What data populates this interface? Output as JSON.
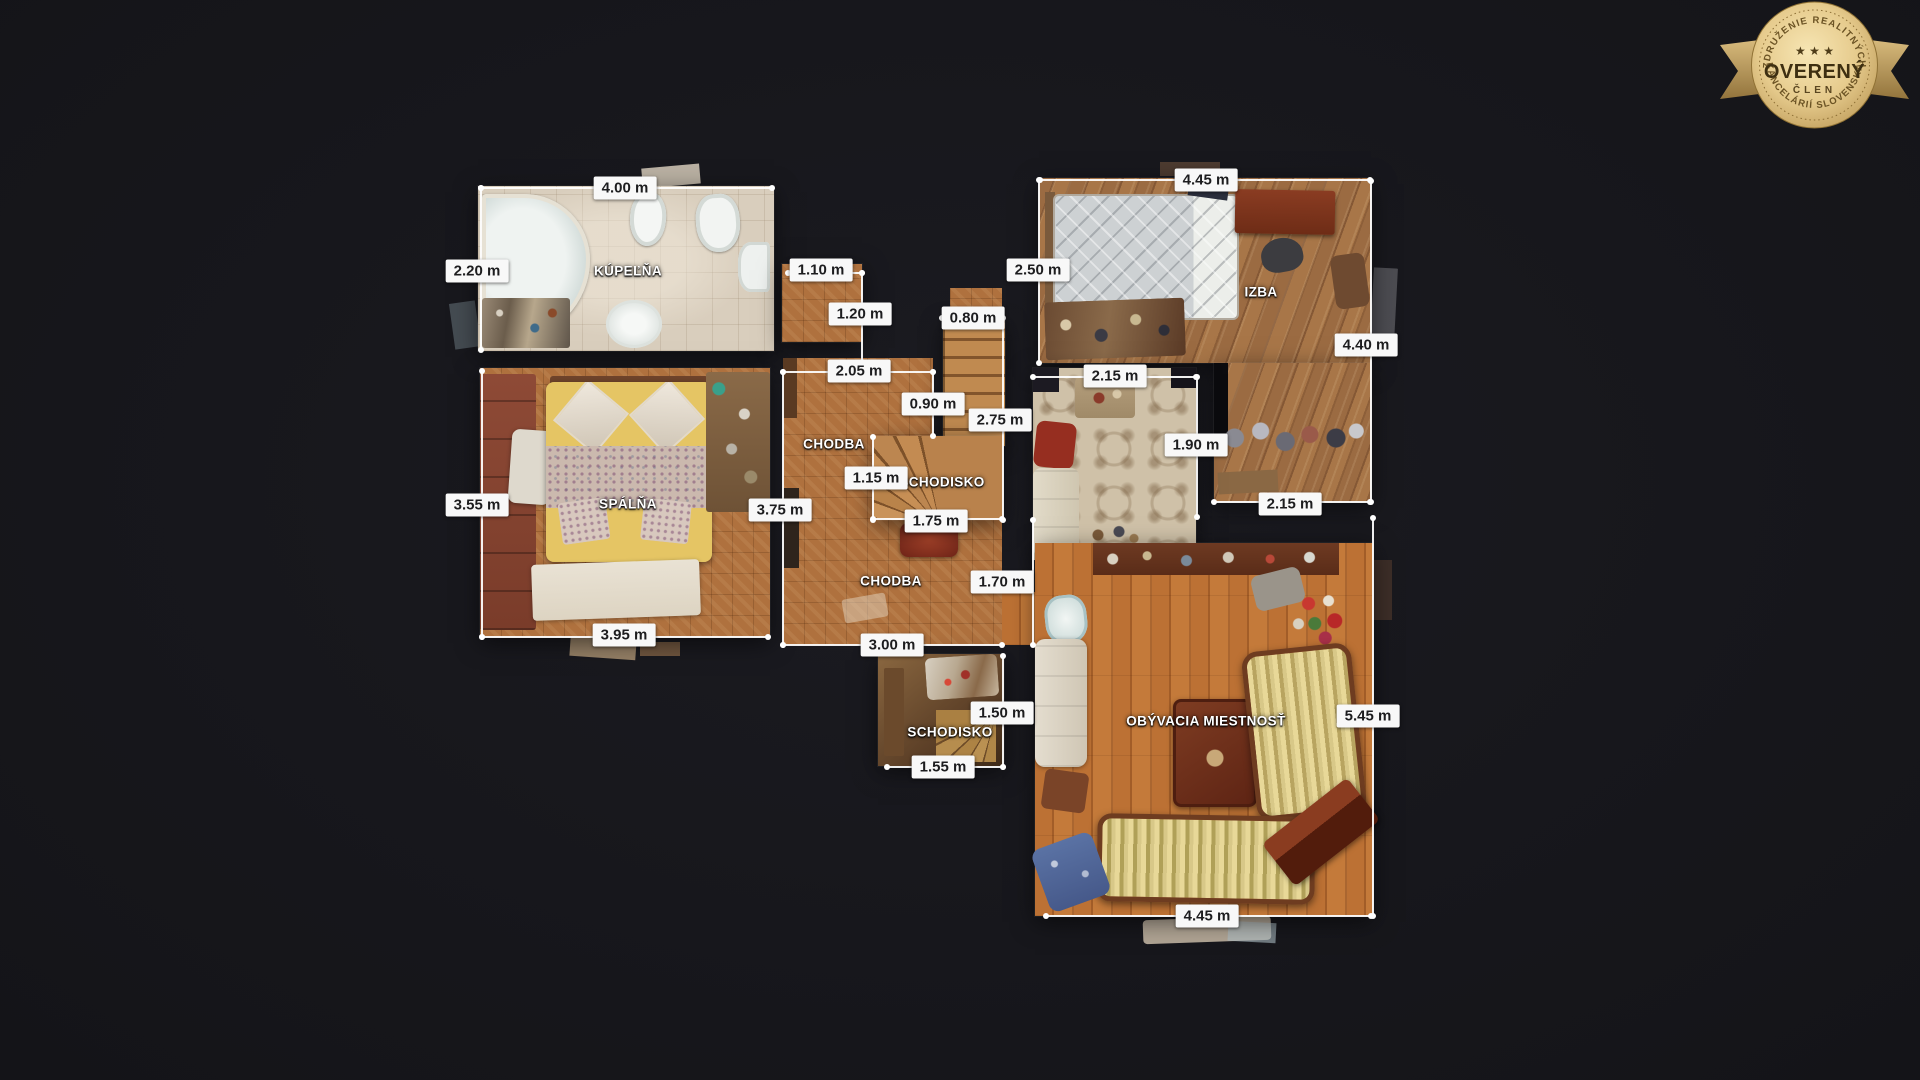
{
  "colors": {
    "background": "#17171c",
    "label_background": "#f8f8f8",
    "label_text": "#1d1d1f",
    "measure_line": "#ffffff",
    "badge_gold": "#e3c584"
  },
  "badge": {
    "arc_top": "ZDRUŽENIE REALITNÝCH",
    "stars": "★ ★ ★",
    "title": "OVERENÝ",
    "subtitle": "ČLEN",
    "arc_bottom": "KANCELÁRIÍ SLOVENSKA"
  },
  "rooms": {
    "kupelna": "KÚPEĽŇA",
    "spalna": "SPÁLŇA",
    "chodba_upper": "CHODBA",
    "schodisko_upper": "SCHODISKO",
    "chodba_lower": "CHODBA",
    "izba": "IZBA",
    "obyvacia": "OBÝVACIA MIESTNOSŤ",
    "schodisko_lower": "SCHODISKO"
  },
  "dimensions": {
    "kupelna_width": "4.00 m",
    "kupelna_depth": "2.20 m",
    "entry_width": "1.10 m",
    "entry_depth": "1.20 m",
    "chodba_width": "2.05 m",
    "stairs_top_width": "0.80 m",
    "stairs_mid_width": "0.90 m",
    "stairs_height": "2.75 m",
    "izba_width": "4.45 m",
    "izba_depth": "2.50 m",
    "izba_right": "4.40 m",
    "tiled_width": "2.15 m",
    "tiled_depth": "1.90 m",
    "izba_ext_width": "2.15 m",
    "chodba_inner_width": "1.15 m",
    "stairs_exit_width": "1.75 m",
    "chodba_depth": "3.75 m",
    "passage_depth": "1.70 m",
    "chodba_bottom_width": "3.00 m",
    "spalna_depth": "3.55 m",
    "spalna_width": "3.95 m",
    "schodisko2_depth": "1.50 m",
    "schodisko2_width": "1.55 m",
    "obyvacia_depth": "5.45 m",
    "obyvacia_width": "4.45 m"
  }
}
